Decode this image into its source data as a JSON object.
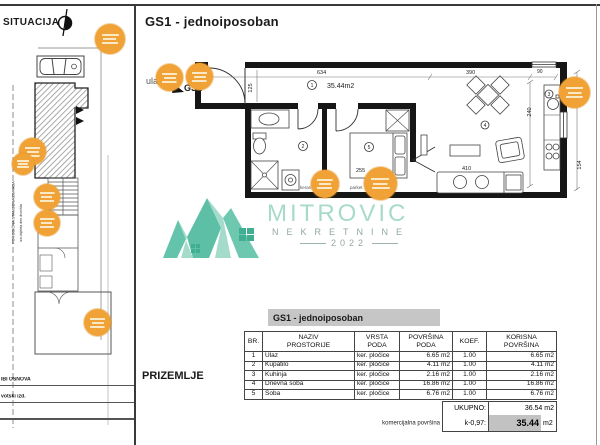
{
  "situacija": {
    "title": "SITUACIJA",
    "note_vertical_1": "PORODIČNA STAMBENA ZGRADA",
    "note_vertical_2": "iza objekta deo dvorišta",
    "footer_label_1": "IBI OSNOVA",
    "footer_label_2": "votski izd."
  },
  "plan": {
    "title": "GS1 - jednoiposoban",
    "floor_label": "PRIZEMLJE",
    "entrance_label": "ulaz",
    "unit_code": "GS1",
    "unit_area": "35.44m2",
    "dims": {
      "d634": "634",
      "d390": "390",
      "d90": "90",
      "d240": "240",
      "d410": "410",
      "d255": "255",
      "d125": "125",
      "d154": "154"
    },
    "rooms": {
      "hall": "1",
      "bath": "2",
      "kitchen": "3",
      "living": "4",
      "bedroom": "5"
    },
    "floor_labels": {
      "bath": "keram.",
      "bedroom": "parket"
    }
  },
  "watermark": {
    "brand": "MITROVIC",
    "subtitle": "NEKRETNINE",
    "year": "2022"
  },
  "table": {
    "title": "GS1 - jednoiposoban",
    "headers": [
      {
        "l1": "BR.",
        "l2": ""
      },
      {
        "l1": "NAZIV",
        "l2": "PROSTORIJE"
      },
      {
        "l1": "VRSTA",
        "l2": "PODA"
      },
      {
        "l1": "POVRŠINA",
        "l2": "PODA"
      },
      {
        "l1": "KOEF.",
        "l2": ""
      },
      {
        "l1": "KORISNA",
        "l2": "POVRŠINA"
      }
    ],
    "rows": [
      [
        "1",
        "Ulaz",
        "ker. pločice",
        "6.65 m2",
        "1.00",
        "6.65 m2"
      ],
      [
        "2",
        "Kupatilo",
        "ker. pločice",
        "4.11 m2",
        "1.00",
        "4.11 m2"
      ],
      [
        "3",
        "Kuhinja",
        "ker. pločice",
        "2.16 m2",
        "1.00",
        "2.16 m2"
      ],
      [
        "4",
        "Dnevna soba",
        "ker. pločice",
        "16.86 m2",
        "1.00",
        "16.86 m2"
      ],
      [
        "5",
        "Soba",
        "ker. pločice",
        "6.76 m2",
        "1.00",
        "6.76 m2"
      ]
    ],
    "total_label": "UKUPNO:",
    "total_value": "36.54 m2",
    "commercial_label": "komercijalna površina",
    "coef_label": "k-0,97:",
    "commercial_value": "35.44",
    "commercial_unit": "m2"
  },
  "colors": {
    "marker_orange": "#f0a236",
    "watermark_teal": "#9ed7c6",
    "watermark_gray": "#93a8a3",
    "title_band_gray": "#c6c6c6",
    "highlight_gray": "#c2c2c2",
    "wall_black": "#161616"
  }
}
